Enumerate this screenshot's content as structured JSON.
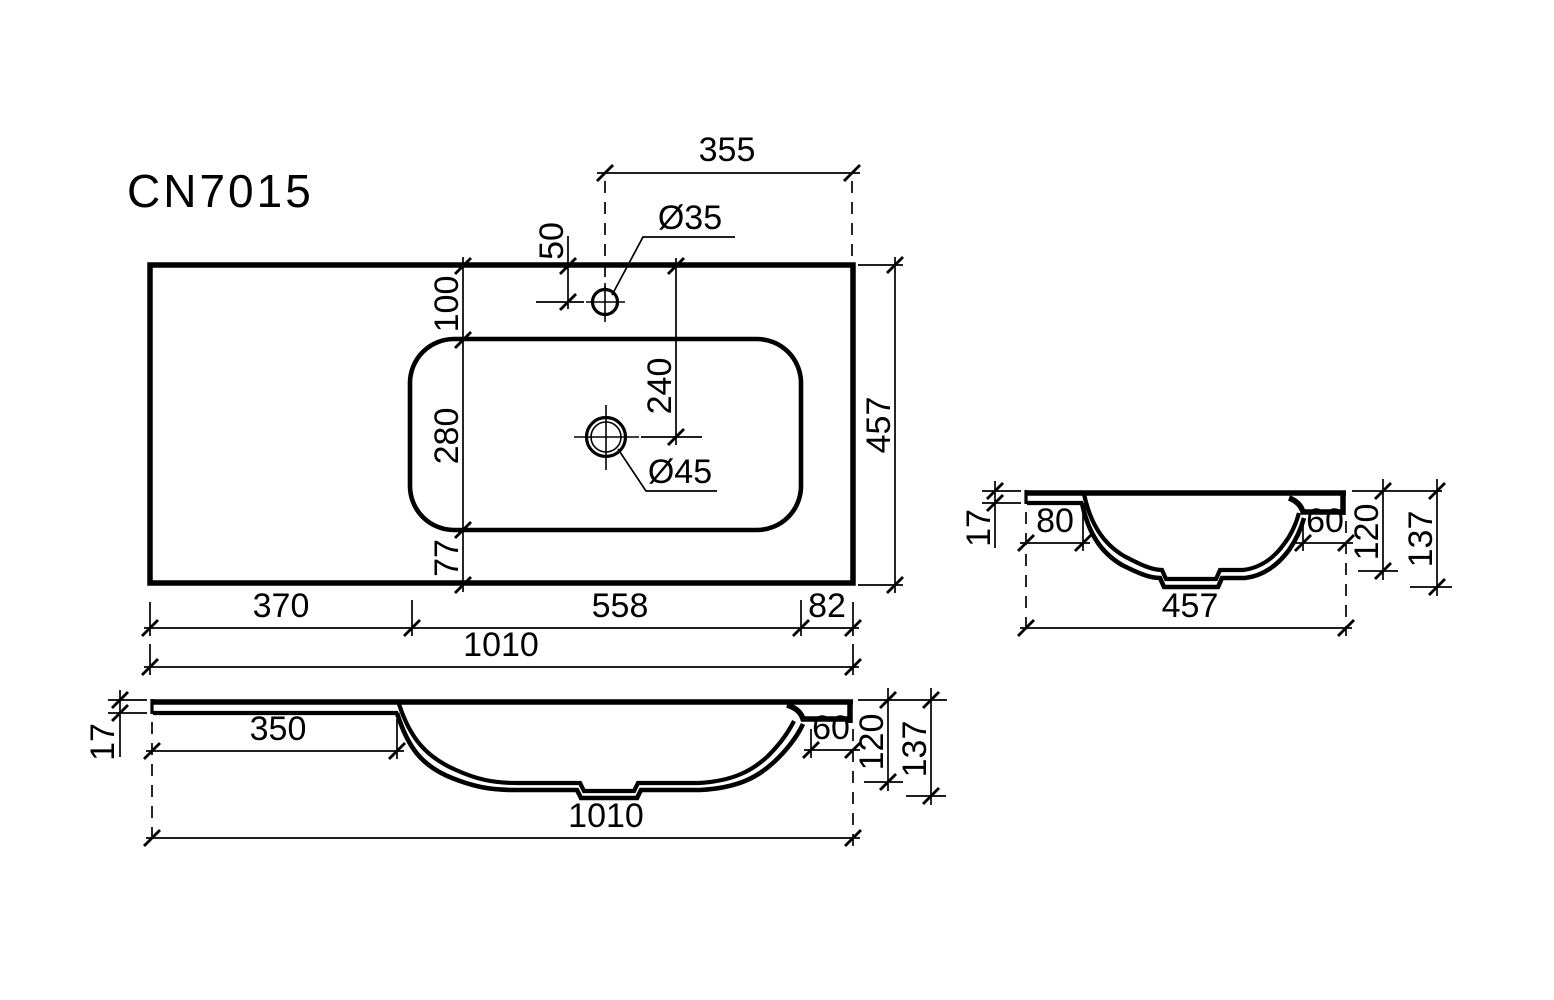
{
  "title": "CN7015",
  "colors": {
    "line": "#000000",
    "background": "#ffffff"
  },
  "top_view": {
    "dim_faucet_from_right": "355",
    "dim_faucet_from_top": "50",
    "faucet_hole_diameter": "Ø35",
    "dim_basin_offset_top": "100",
    "dim_drain_from_top": "240",
    "dim_basin_depth": "280",
    "dim_basin_offset_bottom": "77",
    "drain_hole_diameter": "Ø45",
    "dim_total_depth": "457",
    "dim_left_deck": "370",
    "dim_basin_length": "558",
    "dim_right_deck": "82",
    "dim_total_length": "1010"
  },
  "front_section": {
    "dim_rim_thickness": "17",
    "dim_left_deck": "350",
    "dim_right_ledge": "60",
    "dim_basin_depth": "120",
    "dim_total_height": "137",
    "dim_total_length": "1010"
  },
  "side_section": {
    "dim_rim_thickness": "17",
    "dim_back_ledge": "80",
    "dim_front_ledge": "60",
    "dim_basin_depth": "120",
    "dim_total_height": "137",
    "dim_total_width": "457"
  }
}
